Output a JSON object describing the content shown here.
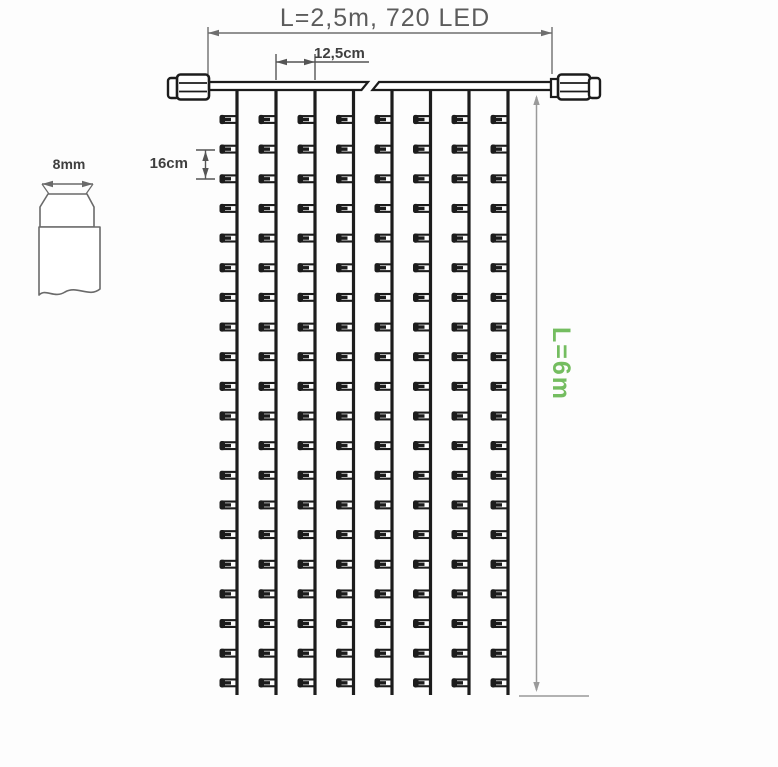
{
  "title": {
    "text": "L=2,5m, 720 LED"
  },
  "annotations": {
    "strand_spacing": "12,5cm",
    "led_spacing": "16cm",
    "bulb_width": "8mm",
    "drop_length": "L=6m"
  },
  "colors": {
    "background": "#fdfdfd",
    "line_black": "#1c1c1c",
    "dimension_gray": "#6e6e6e",
    "dimension_light": "#9a9a9a",
    "detail_gray": "#6a6a6a",
    "title_text": "#5c5c5c",
    "label_text": "#3f3f3f",
    "green_text": "#74bd60"
  },
  "drawing": {
    "type": "technical-drawing",
    "strands_drawn": 8,
    "leds_per_strand_drawn": 20,
    "strand_x": [
      237,
      276,
      315,
      353.5,
      392,
      430.5,
      469,
      508
    ],
    "strand_top_y": 89,
    "strand_bottom_y": 695,
    "led_first_y": 119.5,
    "led_pitch_y": 29.65,
    "cable": {
      "x1": 209,
      "x2": 551,
      "y_top": 82,
      "y_bottom": 90,
      "break_left_top": 368,
      "break_right_top": 379,
      "break_skew": 6.5
    },
    "top_dim": {
      "x1": 208,
      "x2": 552,
      "line_y": 33,
      "ext_top": 27,
      "ext_bottom": 74
    },
    "mid_dim": {
      "x1": 276,
      "x2": 315,
      "line_y": 62,
      "tail_x": 369,
      "ext_top": 54,
      "ext_bottom": 80
    },
    "led_dim": {
      "x": 205.5,
      "y1": 150,
      "y2": 179,
      "tick_x1": 196,
      "tick_x2": 215
    },
    "bulb_dim": {
      "x1": 42,
      "x2": 93,
      "y": 184
    },
    "drop_dim": {
      "x": 536.5,
      "y1": 97,
      "y2": 690,
      "base_y": 696,
      "base_x1": 519,
      "base_x2": 589
    }
  }
}
